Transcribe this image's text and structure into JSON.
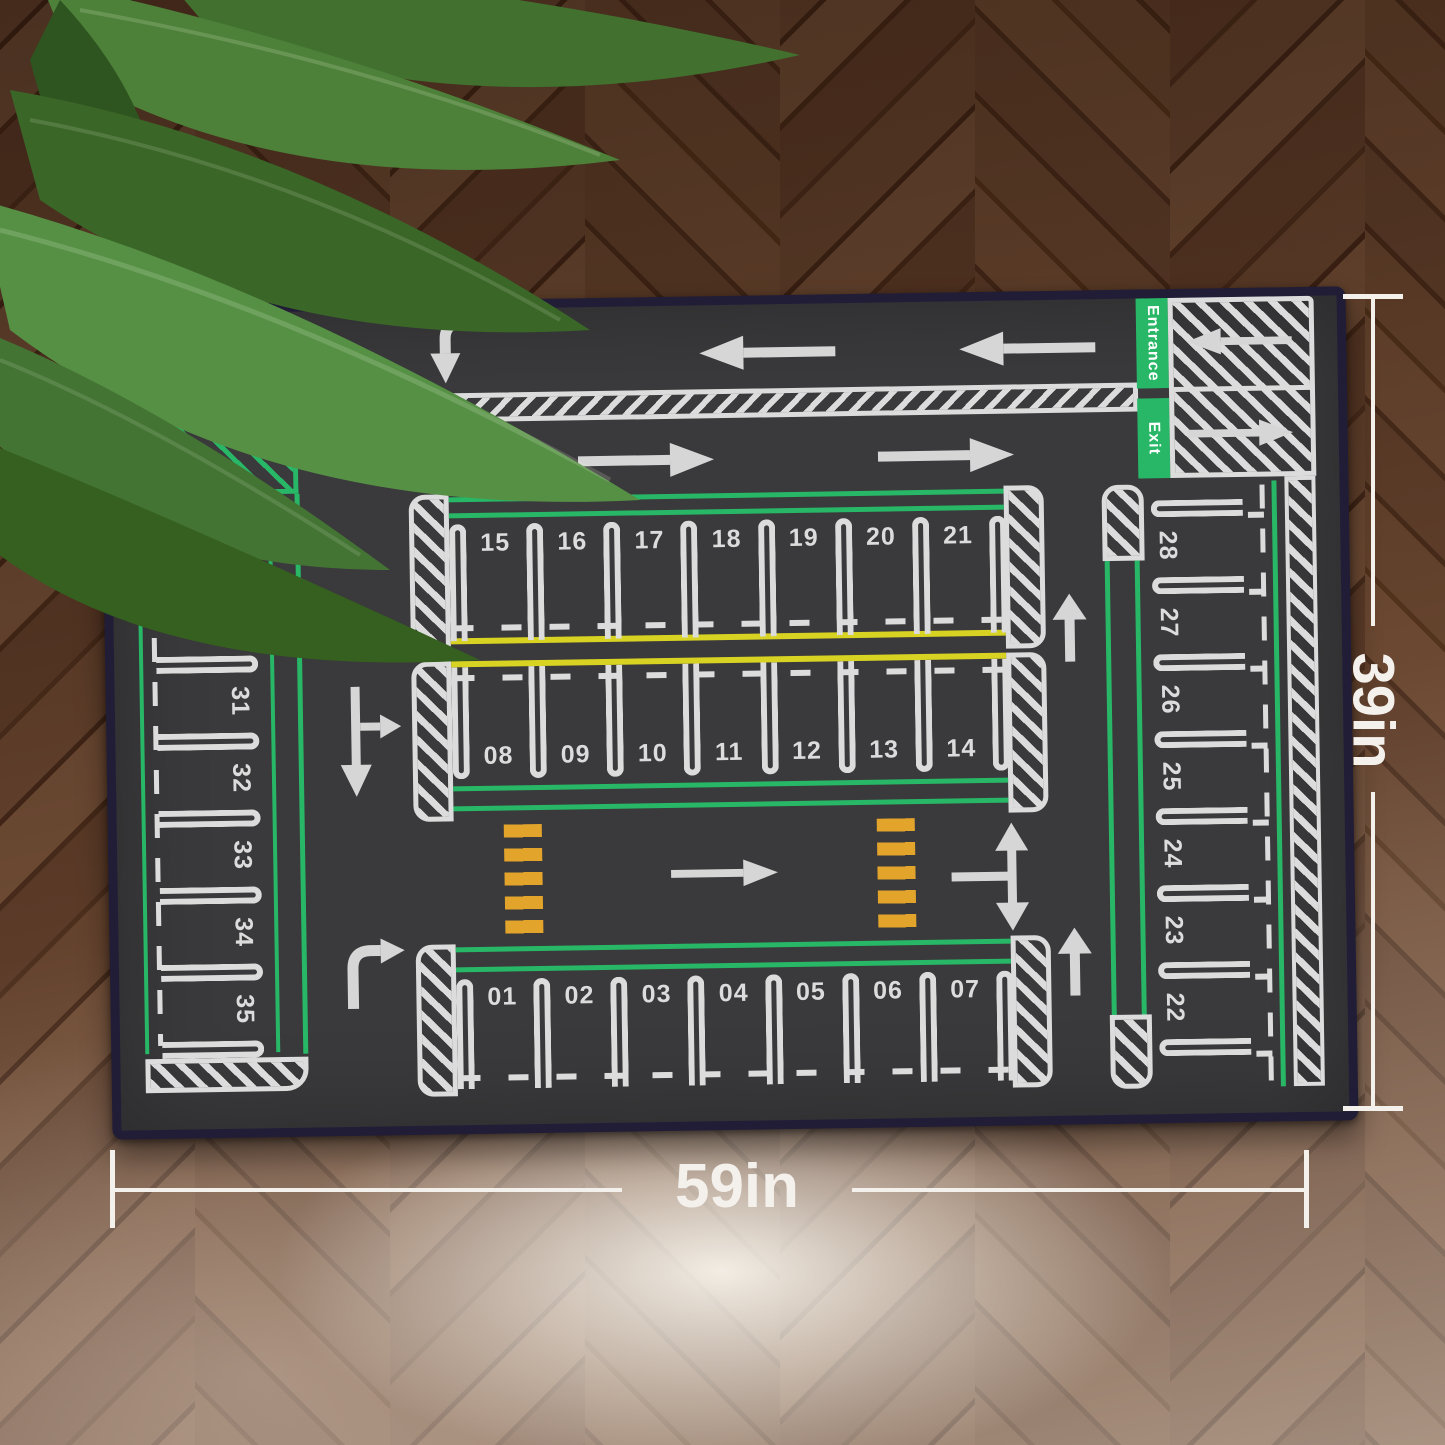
{
  "scene": {
    "description": "Product photo: kids parking-lot road play mat lying on herringbone wood floor with plant leaves in the top-left corner"
  },
  "mat": {
    "entrance_label": "Entrance",
    "exit_label": "Exit",
    "stall_rows": {
      "top": [
        "15",
        "16",
        "17",
        "18",
        "19",
        "20",
        "21"
      ],
      "middle": [
        "08",
        "09",
        "10",
        "11",
        "12",
        "13",
        "14"
      ],
      "bottom": [
        "01",
        "02",
        "03",
        "04",
        "05",
        "06",
        "07"
      ],
      "left_column": [
        "29",
        "30",
        "31",
        "32",
        "33",
        "34",
        "35"
      ],
      "right_column": [
        "28",
        "27",
        "26",
        "25",
        "24",
        "23",
        "22"
      ]
    },
    "colors": {
      "surface": "#3a393b",
      "edge_binding": "#221d37",
      "lane_green": "#28b766",
      "divider_yellow": "#d8d322",
      "crosswalk_orange": "#e2a42a",
      "marking_white": "#dcdcdc"
    }
  },
  "annotations": {
    "width_label": "59in",
    "height_label": "39in",
    "line_color": "#f4f1ec"
  }
}
